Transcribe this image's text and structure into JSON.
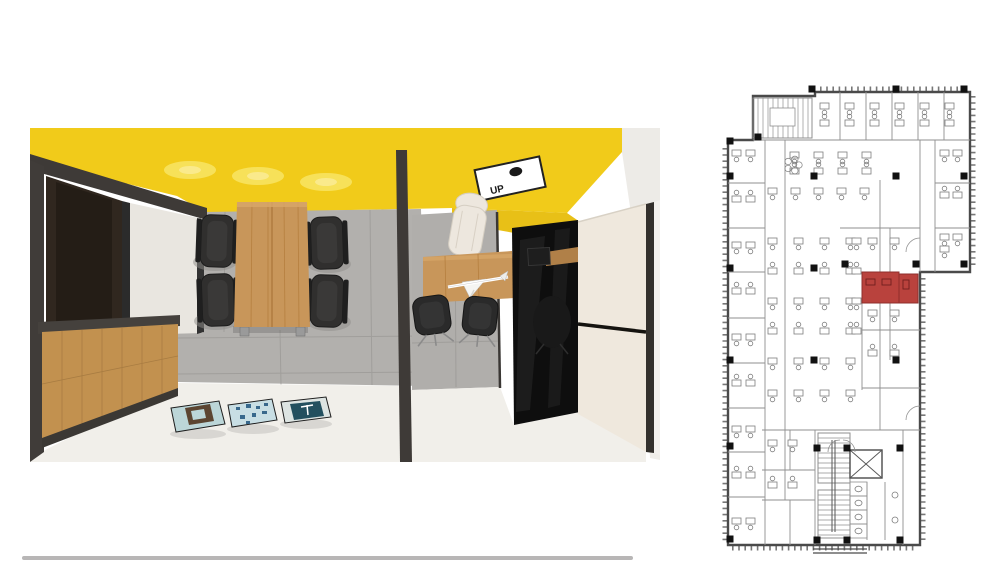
{
  "image": {
    "caption": "Top-down 3D render of a meeting room and private office with a highlighted location on the office floor plan"
  },
  "render": {
    "sign_label": "UP",
    "colors": {
      "ceiling": "#F1CB1A",
      "ceiling_shade": "#E8C017",
      "glow": "#F9E564",
      "glow_core": "#FCF0A0",
      "concrete": "#B2B0AD",
      "concrete_line": "#9C9A97",
      "white_floor": "#F1EFEA",
      "wood": "#C2914F",
      "wood_dark": "#A87C42",
      "table_wood": "#C8965A",
      "frame_dark": "#3E3A37",
      "door_brown": "#30271F",
      "panel_white": "#E9E6E0",
      "wall_white": "#EDEBE7",
      "chair_black": "#302F2E",
      "glass_black": "#0E0E0E",
      "wardrobe_cream": "#EFE8DD",
      "exec_chair": "#EDE7DE"
    },
    "posters": {
      "p1_bg": "#BCD6D8",
      "p1_emblem": "#5C4531",
      "p2_bg": "#C8DEE4",
      "p2_speck": "#38688C",
      "p3_bg": "#DDE4E2",
      "p3_logo_bg": "#23505F",
      "p3_logo": "#FFFFFF"
    }
  },
  "floorplan": {
    "wall_color": "#4A4A4A",
    "partition_color": "#8F8F8F",
    "desk_color": "#7E7E7E",
    "highlight_fill": "#B9423D",
    "highlight_stroke": "#8E2F2C",
    "highlight_desk": "#70201E",
    "outline": "M728,140 L753,140 L753,96 L815,96 L815,92 L970,92 L970,272 L920,272 L920,545 L728,545 Z",
    "window_ticks": [
      [
        725,
        148,
        725,
        542
      ],
      [
        820,
        89,
        966,
        89
      ],
      [
        973,
        96,
        973,
        268
      ],
      [
        923,
        278,
        923,
        542
      ],
      [
        732,
        548,
        916,
        548
      ]
    ],
    "inner_lines": [
      [
        753,
        140,
        970,
        140
      ],
      [
        765,
        140,
        765,
        545
      ],
      [
        728,
        183,
        765,
        183
      ],
      [
        728,
        228,
        765,
        228
      ],
      [
        728,
        272,
        765,
        272
      ],
      [
        728,
        318,
        765,
        318
      ],
      [
        728,
        363,
        765,
        363
      ],
      [
        728,
        408,
        765,
        408
      ],
      [
        728,
        452,
        765,
        452
      ],
      [
        728,
        497,
        765,
        497
      ],
      [
        840,
        92,
        840,
        140
      ],
      [
        866,
        92,
        866,
        140
      ],
      [
        892,
        92,
        892,
        140
      ],
      [
        918,
        92,
        918,
        140
      ],
      [
        944,
        92,
        944,
        140
      ],
      [
        935,
        140,
        935,
        272
      ],
      [
        935,
        183,
        970,
        183
      ],
      [
        935,
        228,
        970,
        228
      ],
      [
        920,
        140,
        920,
        272
      ],
      [
        785,
        140,
        785,
        500
      ],
      [
        880,
        180,
        880,
        430
      ],
      [
        840,
        228,
        920,
        228
      ],
      [
        890,
        228,
        890,
        272
      ],
      [
        862,
        303,
        862,
        390
      ],
      [
        890,
        303,
        890,
        360
      ],
      [
        862,
        330,
        920,
        330
      ],
      [
        862,
        388,
        920,
        388
      ],
      [
        762,
        430,
        920,
        430
      ],
      [
        815,
        430,
        815,
        545
      ],
      [
        762,
        470,
        815,
        470
      ],
      [
        790,
        430,
        790,
        470
      ],
      [
        762,
        500,
        815,
        500
      ],
      [
        790,
        500,
        790,
        545
      ],
      [
        850,
        482,
        850,
        540
      ],
      [
        867,
        482,
        867,
        540
      ],
      [
        885,
        482,
        885,
        540
      ],
      [
        903,
        430,
        903,
        545
      ],
      [
        818,
        433,
        850,
        433
      ]
    ],
    "stair_hatch": [
      {
        "x": 753,
        "y": 98,
        "w": 59,
        "h": 40,
        "step": 5,
        "dir": "v"
      },
      {
        "x": 818,
        "y": 433,
        "w": 32,
        "h": 50,
        "step": 5,
        "dir": "h"
      },
      {
        "x": 818,
        "y": 490,
        "w": 32,
        "h": 48,
        "step": 5,
        "dir": "h"
      }
    ],
    "stair_rails": [
      [
        832,
        440,
        832,
        532
      ],
      [
        835,
        440,
        835,
        532
      ]
    ],
    "landing": {
      "x": 770,
      "y": 108,
      "w": 25,
      "h": 18
    },
    "elevator": {
      "x": 850,
      "y": 450,
      "w": 32,
      "h": 28
    },
    "door_arcs": [
      "M828,452 A12,12 0 0 1 840,440",
      "M843,440 A12,12 0 0 1 855,452",
      "M906,252 A14,14 0 0 1 920,238",
      "M906,420 A14,14 0 0 1 920,406"
    ],
    "toilet_stalls": [
      {
        "x": 850,
        "y": 482,
        "w": 17,
        "h": 14
      },
      {
        "x": 850,
        "y": 496,
        "w": 17,
        "h": 14
      },
      {
        "x": 850,
        "y": 510,
        "w": 17,
        "h": 14
      },
      {
        "x": 850,
        "y": 524,
        "w": 17,
        "h": 14
      }
    ],
    "sinks": [
      [
        895,
        495
      ],
      [
        895,
        520
      ]
    ],
    "desk_clusters": [
      {
        "x": 820,
        "y": 103,
        "cols": 6,
        "rows": 2,
        "dx": 25,
        "dy": 17
      },
      {
        "x": 940,
        "y": 150,
        "cols": 2,
        "rows": 3,
        "dx": 13,
        "dy": 42
      },
      {
        "x": 732,
        "y": 150,
        "cols": 2,
        "rows": 9,
        "dx": 14,
        "dy": 46
      },
      {
        "x": 790,
        "y": 152,
        "cols": 4,
        "rows": 2,
        "dx": 24,
        "dy": 16
      },
      {
        "x": 768,
        "y": 188,
        "cols": 5,
        "rows": 1,
        "dx": 23,
        "dy": 0
      },
      {
        "x": 768,
        "y": 238,
        "cols": 4,
        "rows": 5,
        "dx": 26,
        "dy": 30
      },
      {
        "x": 852,
        "y": 238,
        "cols": 1,
        "rows": 4,
        "dx": 0,
        "dy": 30
      },
      {
        "x": 868,
        "y": 238,
        "cols": 2,
        "rows": 1,
        "dx": 22,
        "dy": 0
      },
      {
        "x": 868,
        "y": 310,
        "cols": 2,
        "rows": 2,
        "dx": 22,
        "dy": 40
      },
      {
        "x": 768,
        "y": 390,
        "cols": 4,
        "rows": 1,
        "dx": 26,
        "dy": 0
      },
      {
        "x": 768,
        "y": 440,
        "cols": 2,
        "rows": 2,
        "dx": 20,
        "dy": 42
      },
      {
        "x": 940,
        "y": 246,
        "cols": 1,
        "rows": 1,
        "dx": 0,
        "dy": 0
      }
    ],
    "plants": [
      [
        793,
        165
      ]
    ],
    "red_rooms": [
      {
        "x": 862,
        "y": 272,
        "w": 37,
        "h": 31
      },
      {
        "x": 899,
        "y": 274,
        "w": 19,
        "h": 29
      }
    ],
    "red_desks": [
      {
        "x": 866,
        "y": 279,
        "w": 9,
        "h": 6
      },
      {
        "x": 882,
        "y": 279,
        "w": 9,
        "h": 6
      },
      {
        "x": 903,
        "y": 280,
        "w": 6,
        "h": 9
      }
    ],
    "columns": [
      [
        730,
        141
      ],
      [
        758,
        137
      ],
      [
        730,
        176
      ],
      [
        730,
        268
      ],
      [
        730,
        360
      ],
      [
        730,
        446
      ],
      [
        730,
        539
      ],
      [
        814,
        176
      ],
      [
        814,
        268
      ],
      [
        814,
        360
      ],
      [
        817,
        448
      ],
      [
        817,
        540
      ],
      [
        847,
        448
      ],
      [
        900,
        448
      ],
      [
        847,
        540
      ],
      [
        900,
        540
      ],
      [
        845,
        264
      ],
      [
        916,
        264
      ],
      [
        896,
        176
      ],
      [
        896,
        360
      ],
      [
        812,
        89
      ],
      [
        896,
        89
      ],
      [
        964,
        89
      ],
      [
        964,
        176
      ],
      [
        964,
        264
      ]
    ],
    "entrance_lines": [
      [
        813,
        549,
        867,
        549
      ],
      [
        813,
        553,
        867,
        553
      ]
    ]
  },
  "scrollbar": {
    "present": true
  }
}
